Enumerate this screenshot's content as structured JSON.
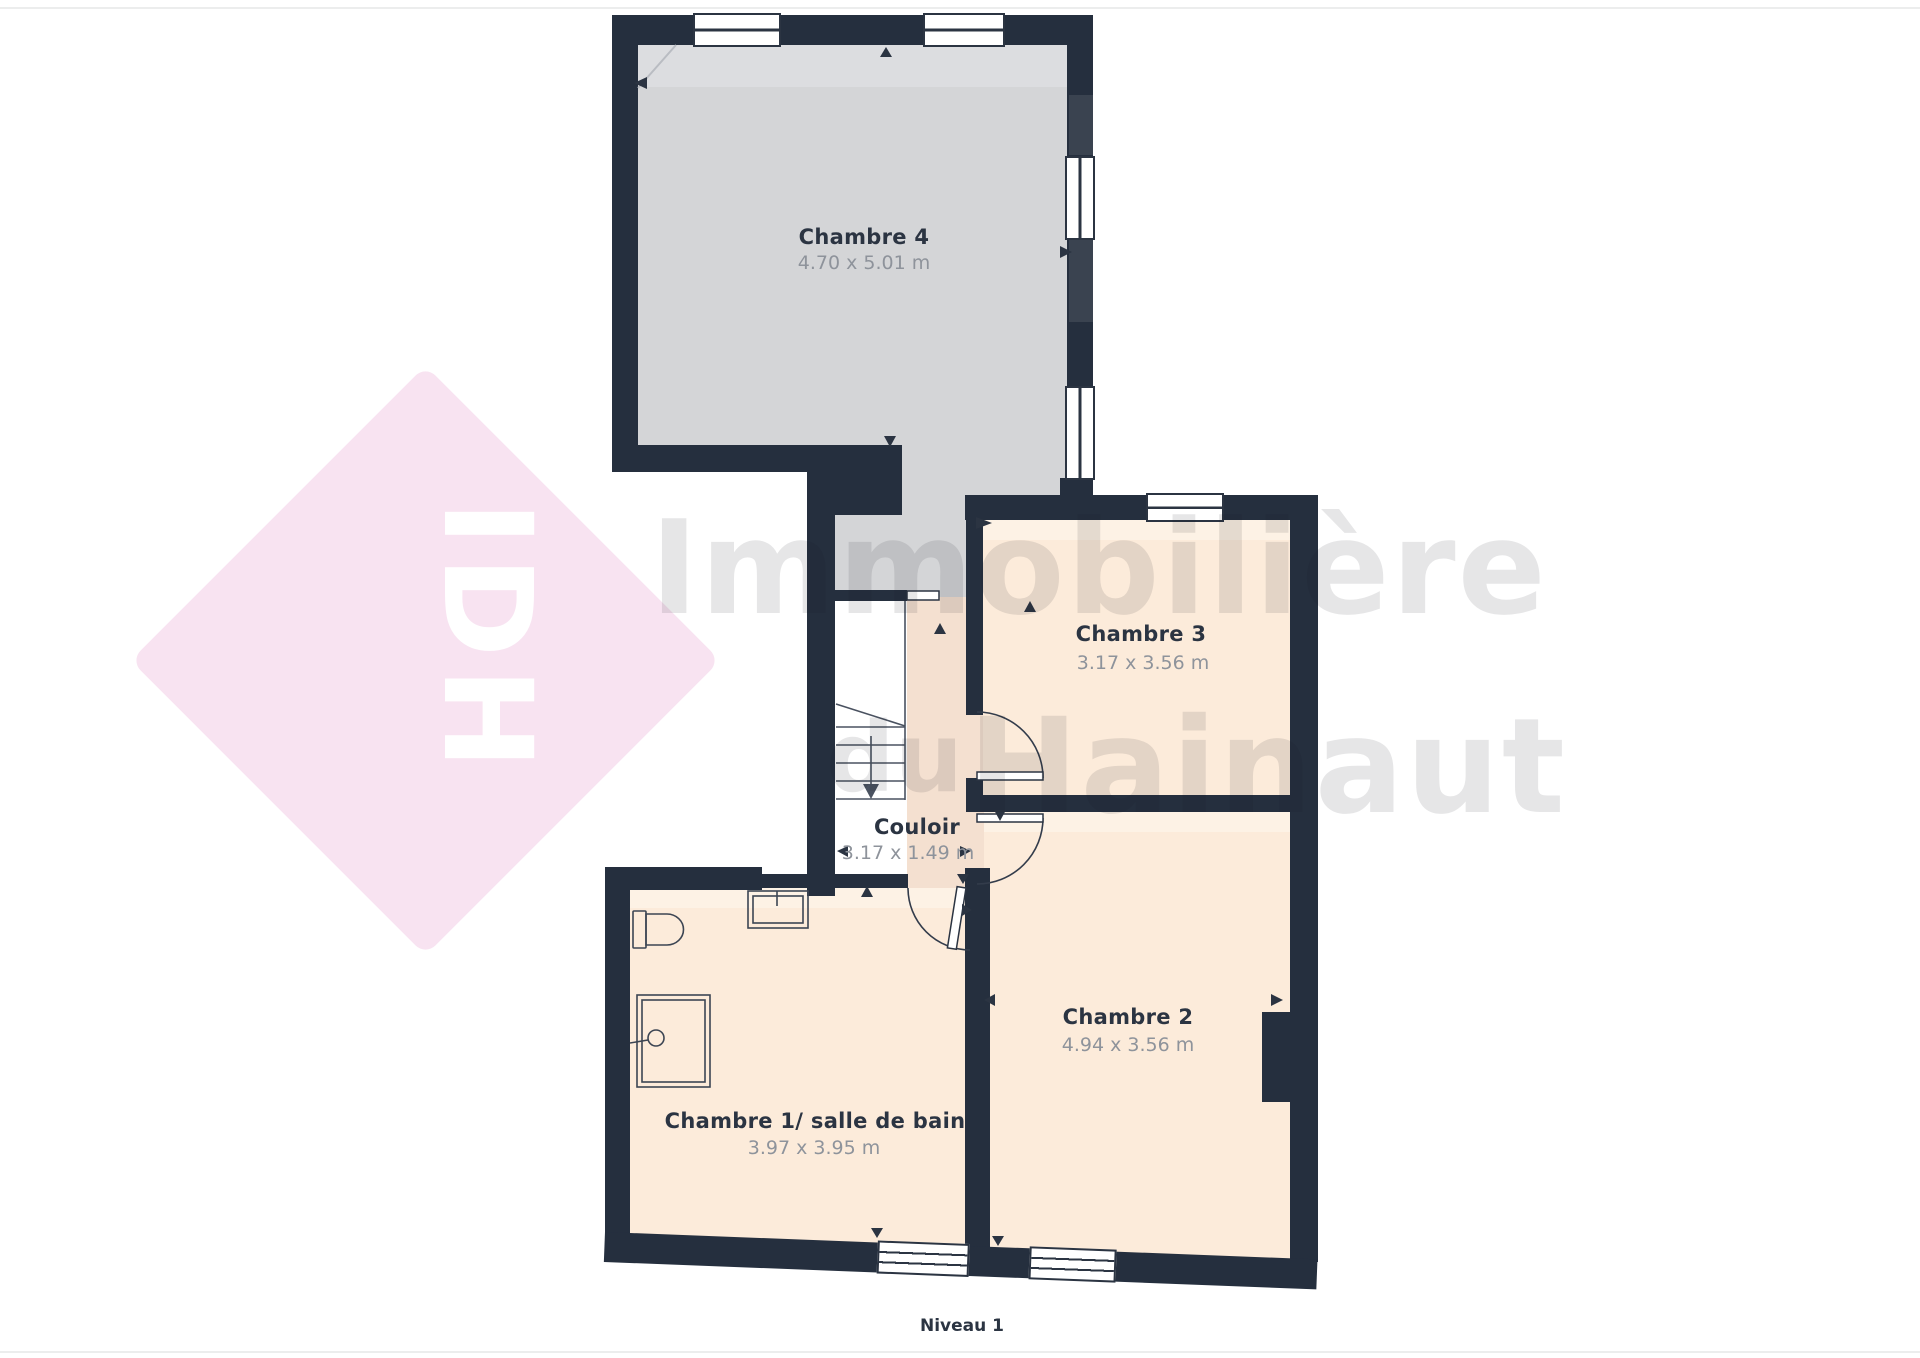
{
  "page": {
    "background": "#ffffff",
    "edge_line_color": "#eceded"
  },
  "plan": {
    "colors": {
      "wall": "#252f3e",
      "wall_light": "#3a4350",
      "room_gray_fill": "#d4d5d7",
      "room_peach_fill": "#fcebda",
      "corridor_fill": "#f4e0d0",
      "line": "#4a5260",
      "label_text": "#2b3442",
      "dimension_text": "#8e939b"
    },
    "rooms": [
      {
        "id": "chambre4",
        "name": "Chambre 4",
        "dimensions": "4.70 x 5.01 m"
      },
      {
        "id": "chambre3",
        "name": "Chambre 3",
        "dimensions": "3.17 x 3.56 m"
      },
      {
        "id": "couloir",
        "name": "Couloir",
        "dimensions": "3.17 x 1.49 m"
      },
      {
        "id": "chambre2",
        "name": "Chambre 2",
        "dimensions": "4.94 x 3.56 m"
      },
      {
        "id": "chambre1",
        "name": "Chambre 1/ salle de bain",
        "dimensions": "3.97 x 3.95 m"
      }
    ],
    "fixtures": [
      "stairs-down",
      "toilet",
      "sink",
      "washbasin"
    ],
    "level_label": "Niveau 1"
  },
  "watermark": {
    "logo_text": "IDH",
    "word1": "Immobilière",
    "word2": "du",
    "word3": "Hainaut",
    "diamond_color": "#f8e3f1",
    "logo_text_color": "#ffffff",
    "text_color": "rgba(25,28,35,0.11)"
  }
}
